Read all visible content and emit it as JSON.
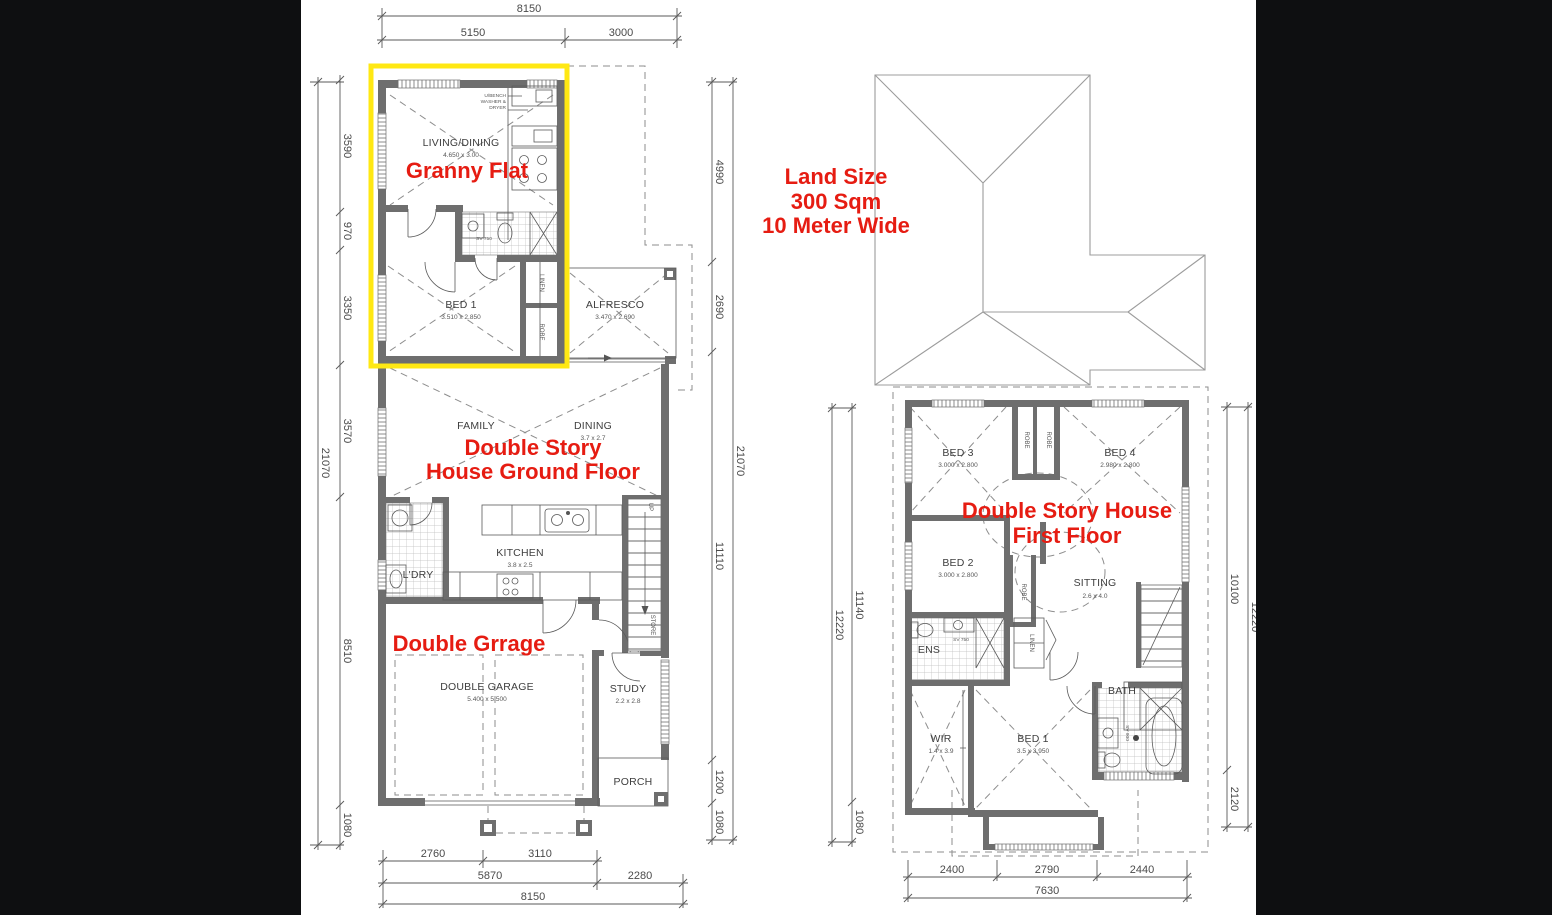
{
  "colors": {
    "background": "#0e0f11",
    "paper": "#ffffff",
    "wall": "#6e6e6e",
    "red_annotation": "#e61c12",
    "highlight_yellow": "#ffe813",
    "linework": "#555555"
  },
  "annotations": {
    "granny_flat": "Granny Flat",
    "ground_floor_1": "Double Story",
    "ground_floor_2": "House  Ground Floor",
    "garage": "Double Grrage",
    "land_1": "Land Size",
    "land_2": "300 Sqm",
    "land_3": "10 Meter Wide",
    "first_floor_1": "Double Story House",
    "first_floor_2": "First Floor"
  },
  "ground_floor": {
    "dim_top": {
      "total": "8150",
      "a": "5150",
      "b": "3000"
    },
    "dim_left": {
      "a": "3590",
      "b": "970",
      "c": "3350",
      "d": "3570",
      "e": "8510",
      "f": "1080",
      "total": "21070"
    },
    "dim_right": {
      "a": "4990",
      "b": "2690",
      "c": "11110",
      "d": "1200",
      "e": "1080",
      "total": "21070"
    },
    "dim_bottom": {
      "a": "2760",
      "b": "3110",
      "c": "5870",
      "d": "2280",
      "total": "8150"
    },
    "rooms": {
      "living": {
        "name": "LIVING/DINING",
        "size": "4.650 x 3.00"
      },
      "bed1": {
        "name": "BED 1",
        "size": "3.510 x 2.850"
      },
      "alfresco": {
        "name": "ALFRESCO",
        "size": "3.470 x 2.690"
      },
      "family": {
        "name": "FAMILY"
      },
      "dining": {
        "name": "DINING",
        "size": "3.7 x 2.7"
      },
      "kitchen": {
        "name": "KITCHEN",
        "size": "3.8 x 2.5"
      },
      "laundry": {
        "name": "L'DRY"
      },
      "garage": {
        "name": "DOUBLE GARAGE",
        "size": "5.400 x 5.500"
      },
      "study": {
        "name": "STUDY",
        "size": "2.2 x 2.8"
      },
      "porch": {
        "name": "PORCH"
      }
    },
    "labels": {
      "sv750": "SV 750",
      "linen": "LINEN",
      "robe": "ROBE",
      "up": "UP",
      "store": "STORE",
      "note_1": "U/BENCH",
      "note_2": "WASHER &",
      "note_3": "DRYER"
    }
  },
  "first_floor": {
    "dim_left": {
      "a": "11140",
      "b": "1080",
      "total": "12220"
    },
    "dim_right": {
      "a": "10100",
      "b": "2120",
      "total": "12220"
    },
    "dim_bottom": {
      "a": "2400",
      "b": "2790",
      "c": "2440",
      "total": "7630"
    },
    "rooms": {
      "bed3": {
        "name": "BED 3",
        "size": "3.000 x 2.800"
      },
      "bed4": {
        "name": "BED 4",
        "size": "2.980 x 2.800"
      },
      "bed2": {
        "name": "BED 2",
        "size": "3.000 x 2.800"
      },
      "sitting": {
        "name": "SITTING",
        "size": "2.6 x 4.0"
      },
      "wir": {
        "name": "WIR",
        "size": "1.4 x 3.9"
      },
      "bed1": {
        "name": "BED 1",
        "size": "3.5 x 3.950"
      },
      "ens": {
        "name": "ENS"
      },
      "bath": {
        "name": "BATH"
      }
    },
    "labels": {
      "robe": "ROBE",
      "linen": "LINEN",
      "sv750": "SV 750",
      "sv900": "SV 900"
    }
  }
}
